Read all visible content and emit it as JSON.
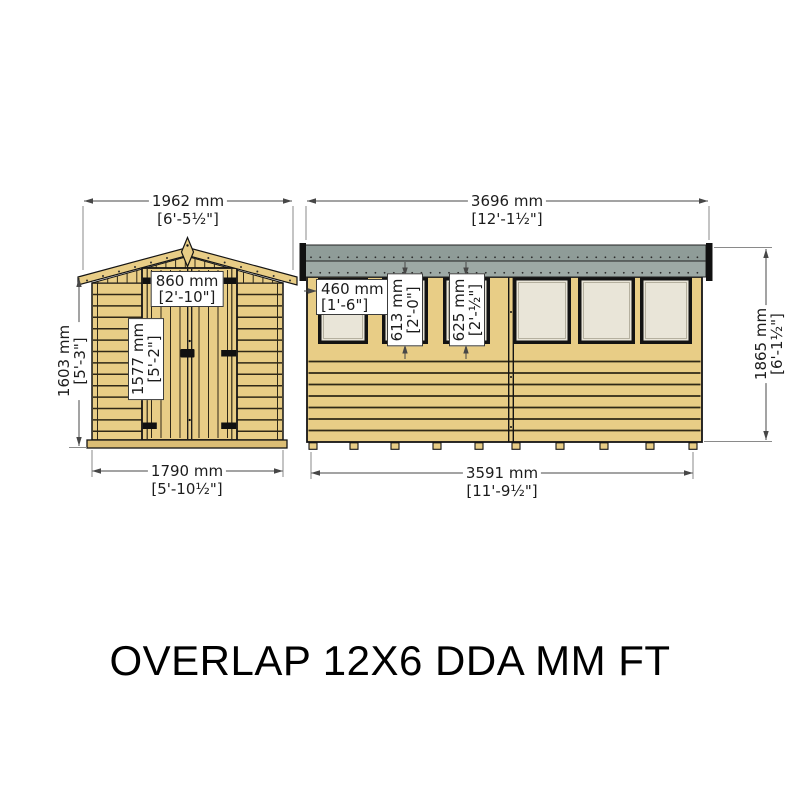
{
  "title": "OVERLAP 12X6 DDA MM FT",
  "colors": {
    "wood": "#e8cd86",
    "wood-dark": "#dcbe75",
    "plank-line": "#2f2817",
    "outline": "#141414",
    "roof-gray-top": "#8f9c98",
    "roof-gray-bottom": "#9da9a5",
    "glass": "#e9e5d8",
    "dim-line": "#474747",
    "ext-line": "#8a8a8a",
    "text": "#1c1c1c"
  },
  "front_view": {
    "label": "end elevation with double door",
    "dim_roof_width": {
      "mm": "1962 mm",
      "ftin": "[6'-5½\"]"
    },
    "dim_wall_height": {
      "mm": "1603 mm",
      "ftin": "[5'-3\"]"
    },
    "dim_door_width": {
      "mm": "860 mm",
      "ftin": "[2'-10\"]"
    },
    "dim_door_height": {
      "mm": "1577 mm",
      "ftin": "[5'-2\"]"
    },
    "dim_base_width": {
      "mm": "1790 mm",
      "ftin": "[5'-10½\"]"
    }
  },
  "side_view": {
    "label": "side elevation with six windows",
    "dim_roof_length": {
      "mm": "3696 mm",
      "ftin": "[12'-1½\"]"
    },
    "dim_window_width": {
      "mm": "460 mm",
      "ftin": "[1'-6\"]"
    },
    "dim_window2_height": {
      "mm": "613 mm",
      "ftin": "[2'-0\"]"
    },
    "dim_window3_height": {
      "mm": "625 mm",
      "ftin": "[2'-½\"]"
    },
    "dim_overall_height": {
      "mm": "1865 mm",
      "ftin": "[6'-1½\"]"
    },
    "dim_base_length": {
      "mm": "3591 mm",
      "ftin": "[11'-9½\"]"
    }
  }
}
